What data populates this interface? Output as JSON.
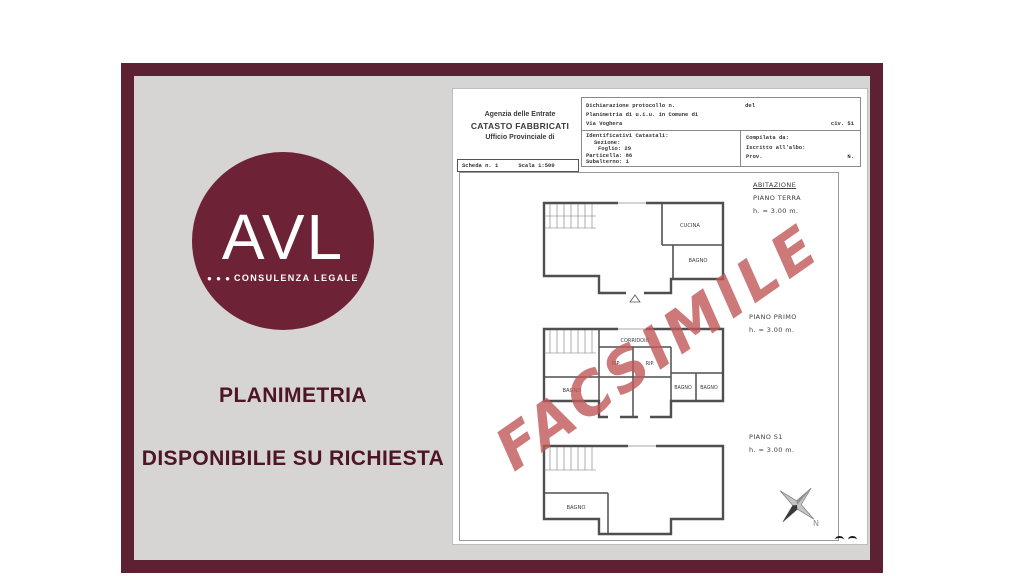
{
  "colors": {
    "frame_maroon": "#5c2132",
    "logo_maroon": "#6e2236",
    "panel_gray": "#d6d5d3",
    "overlay_text": "#4e1527",
    "watermark_red": "#c15858",
    "wall_gray": "#4f4f4f"
  },
  "logo": {
    "acronym": "AVL",
    "dots": "● ● ●",
    "tagline": "CONSULENZA LEGALE"
  },
  "overlay": {
    "line1": "PLANIMETRIA",
    "line2": "DISPONIBILIE SU RICHIESTA"
  },
  "document": {
    "agency": {
      "line1": "Agenzia delle Entrate",
      "line2": "CATASTO FABBRICATI",
      "line3": "Ufficio Provinciale di"
    },
    "protocol": {
      "declaration": "Dichiarazione protocollo n.",
      "del": "del",
      "planimetria": "Planimetria di u.i.u. in Comune di",
      "street": "Via Voghera",
      "civ": "civ. 51"
    },
    "identifiers": {
      "title": "Identificativi Catastali:",
      "sezione": "Sezione:",
      "foglio": "Foglio: 29",
      "particella": "Particella: 86",
      "subalterno": "Subalterno: 1"
    },
    "compiler": {
      "compilata": "Compilata da:",
      "iscritto": "Iscritto all'albo:",
      "prov": "Prov.",
      "n": "N."
    },
    "sheet": {
      "scheda": "Scheda n. 1",
      "scala": "Scala 1:500"
    },
    "watermark": "FACSIMILE",
    "floors": {
      "terra": {
        "title": "ABITAZIONE",
        "subtitle": "PIANO TERRA",
        "height": "h. = 3.00 m.",
        "room_cucina": "CUCINA",
        "room_bagno": "BAGNO"
      },
      "primo": {
        "title": "PIANO PRIMO",
        "height": "h. = 3.00 m.",
        "room_corridoio": "CORRIDOIO",
        "room_rip1": "RIP.",
        "room_rip2": "RIP.",
        "room_bagno1": "BAGNO",
        "room_bagno2": "BAGNO",
        "room_bagno3": "BAGNO"
      },
      "s1": {
        "title": "PIANO S1",
        "height": "h. = 3.00 m.",
        "room_bagno": "BAGNO"
      }
    },
    "compass": {
      "north": "N"
    }
  }
}
